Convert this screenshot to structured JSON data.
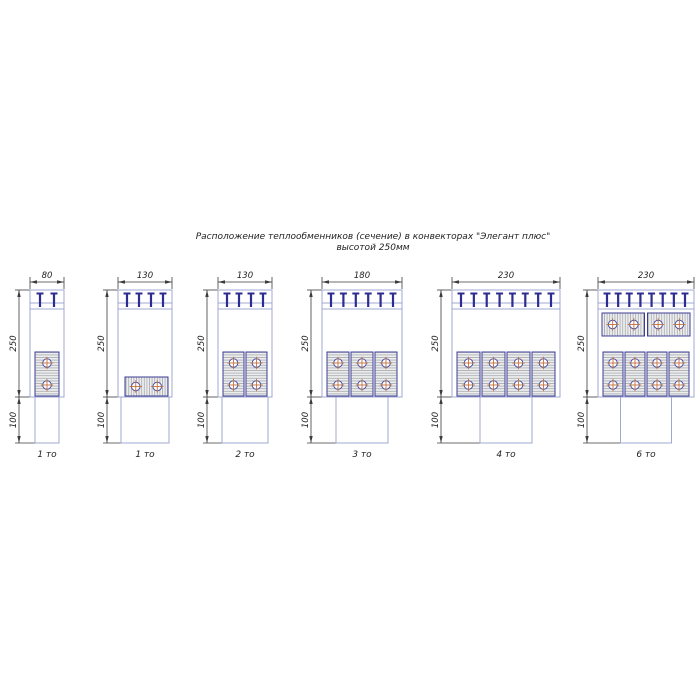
{
  "title": {
    "line1": "Расположение теплообменников (сечение) в конвекторах \"Элегант плюс\"",
    "line2": "высотой 250мм"
  },
  "diagrams": [
    {
      "width_label": "80",
      "height_label": "250",
      "base_height_label": "100",
      "caption": "1 то",
      "bracket_count": 2,
      "vertical_exchangers": 1,
      "top_horizontal_exchangers": 0,
      "bottom_horizontal_exchanger": true
    },
    {
      "width_label": "130",
      "height_label": "250",
      "base_height_label": "100",
      "caption": "1 то",
      "bracket_count": 4,
      "vertical_exchangers": 0,
      "top_horizontal_exchangers": 0,
      "bottom_horizontal_exchanger": false,
      "low_horizontal_exchanger": true
    },
    {
      "width_label": "130",
      "height_label": "250",
      "base_height_label": "100",
      "caption": "2 то",
      "bracket_count": 4,
      "vertical_exchangers": 2,
      "top_horizontal_exchangers": 0
    },
    {
      "width_label": "180",
      "height_label": "250",
      "base_height_label": "100",
      "caption": "3 то",
      "bracket_count": 6,
      "vertical_exchangers": 3,
      "top_horizontal_exchangers": 0
    },
    {
      "width_label": "230",
      "height_label": "250",
      "base_height_label": "100",
      "caption": "4 то",
      "bracket_count": 8,
      "vertical_exchangers": 4,
      "top_horizontal_exchangers": 0
    },
    {
      "width_label": "230",
      "height_label": "250",
      "base_height_label": "100",
      "caption": "6 то",
      "bracket_count": 8,
      "vertical_exchangers": 4,
      "top_horizontal_exchangers": 2
    }
  ],
  "colors": {
    "casing": "#9fa9d0",
    "exchanger_outline": "#3d3d94",
    "exchanger_fill": "#ededed",
    "hatch": "#999fa8",
    "bracket": "#2d2d91",
    "dimension": "#3c3c3c",
    "text": "#1f1f1f",
    "tube_cross": "#c2713b",
    "tube_outline": "#5252a2",
    "background": "#ffffff"
  }
}
